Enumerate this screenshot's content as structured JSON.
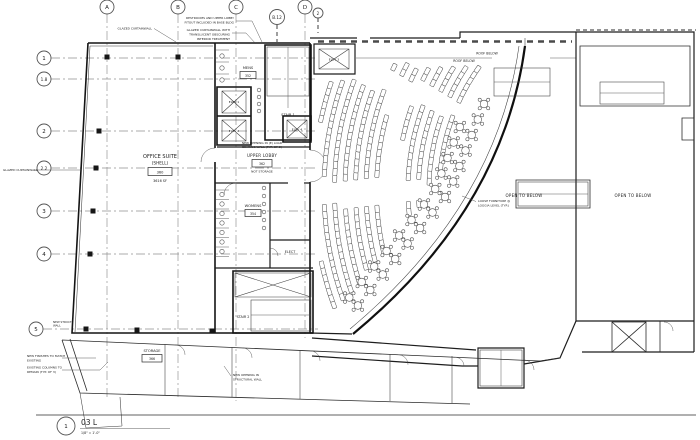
{
  "drawing": {
    "grid": {
      "cols": [
        "A",
        "B",
        "C",
        "D"
      ],
      "rows": [
        "1",
        "1.8",
        "2",
        "2.2",
        "3",
        "4",
        "5"
      ],
      "ref_bubble": "B.12",
      "keynote": "2"
    },
    "rooms": {
      "office": {
        "name": "OFFICE SUITE",
        "sub": "(SHELL)",
        "number": "360",
        "area": "3616 SF"
      },
      "mens": {
        "name": "MENS",
        "number": "352"
      },
      "womens": {
        "name": "WOMENS",
        "number": "354"
      },
      "upper_lobby": {
        "name": "UPPER LOBBY",
        "number": "362",
        "note": "NOT STORAGE"
      },
      "storage": {
        "name": "STORAGE",
        "number": "366"
      },
      "stair1": {
        "name": "STAIR 1"
      },
      "stair2": {
        "name": "STAIR 2"
      },
      "elev1": {
        "name": "ELEV 1"
      },
      "elev2": {
        "name": "ELEV 2"
      },
      "elev3": {
        "name": "ELEV 3"
      },
      "elev4": {
        "name": "ELEV 4"
      },
      "elect": {
        "name": "ELECT"
      }
    },
    "annotations": {
      "glazed_curtainwall_top": "GLAZED CURTAINWALL",
      "glazed_curtainwall_left": "GLAZED CURTAINWALL",
      "restrooms_note_1": "RESTROOMS AND UPPER LOBBY",
      "restrooms_note_2": "FITOUT INCLUDED IN BASE BLDG",
      "translucent_1": "GLAZED CURTAINWALL WITH",
      "translucent_2": "TRANSLUCENT OBSCURING",
      "translucent_3": "INTERIOR TREATMENT",
      "new_opening_1": "NEW OPENING IN (E) LOAD",
      "new_opening_2": "BEARING WALL (TYP. OF 2)",
      "roof_below_1": "ROOF BELOW",
      "roof_below_2": "ROOF BELOW",
      "open_to_below_1": "OPEN TO BELOW",
      "open_to_below_2": "OPEN TO BELOW",
      "loose_furniture_1": "LOOSE FURNITURE @",
      "loose_furniture_2": "LOGGIA LEVEL (TYP.)",
      "new_finishes_1": "NEW FINISHES TO MATCH",
      "new_finishes_2": "EXISTING",
      "existing_columns_1": "EXISTING COLUMNS TO",
      "existing_columns_2": "REMAIN (TYP. OF 3)",
      "struct_opening_1": "NEW OPENING IN",
      "struct_opening_2": "STRUCTURAL WALL",
      "new_struct_1": "NEW STRUCT.",
      "new_struct_2": "WALL"
    },
    "titleblock": {
      "detail_number": "1",
      "sheet_ref": "03 L",
      "scale": "1/8\" = 1'-0\""
    }
  }
}
